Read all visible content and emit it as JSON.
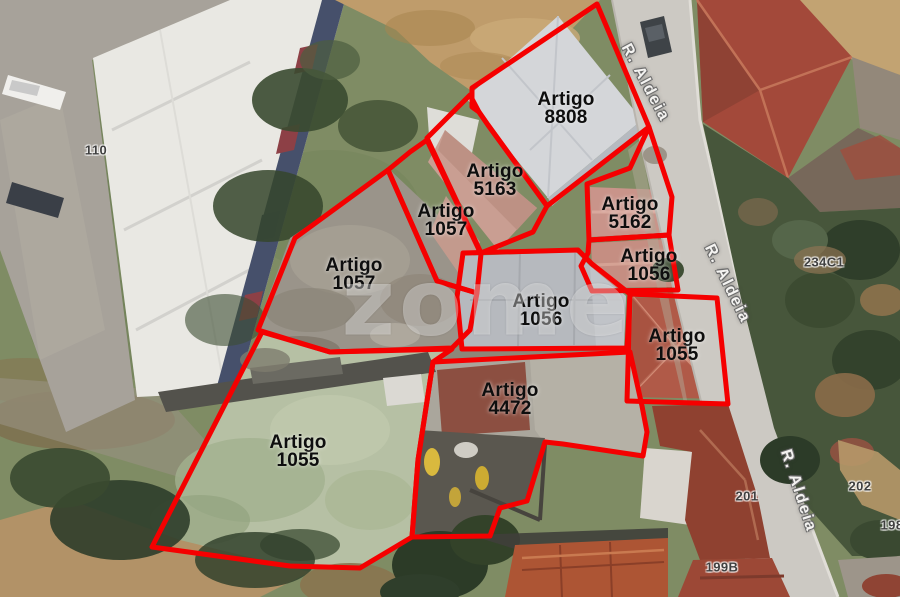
{
  "watermark": "zome",
  "map": {
    "boundary_color": "#f50000",
    "parcels": [
      {
        "name": "Artigo",
        "number": "8808",
        "label_x": 566,
        "label_y": 109,
        "points": "597,4 649,127 547,206 488,125 479,112 472,107 472,88"
      },
      {
        "name": "Artigo",
        "number": "5163",
        "label_x": 495,
        "label_y": 181,
        "points": "470,95 479,112 488,125 547,206 533,232 481,253 427,138"
      },
      {
        "name": "Artigo",
        "number": "1057",
        "label_x": 446,
        "label_y": 221,
        "points": "410,152 427,140 481,254 477,293 437,281 388,170"
      },
      {
        "name": "Artigo",
        "number": "1057",
        "label_x": 354,
        "label_y": 275,
        "points": "295,238 388,170 437,281 477,293 470,330 452,348 330,352 258,330"
      },
      {
        "name": "Artigo",
        "number": "5162",
        "label_x": 630,
        "label_y": 214,
        "points": "587,184 630,168 649,127 672,197 669,235 589,240"
      },
      {
        "name": "Artigo",
        "number": "1056",
        "label_x": 649,
        "label_y": 266,
        "points": "589,240 669,235 678,290 592,291 581,266 588,253"
      },
      {
        "name": "Artigo",
        "number": "1055",
        "label_x": 677,
        "label_y": 346,
        "points": "630,294 717,298 728,404 627,401"
      },
      {
        "name": "Artigo",
        "number": "1056",
        "label_x": 541,
        "label_y": 311,
        "points": "463,253 578,250 592,264 630,294 627,348 462,349 457,297"
      },
      {
        "name": "Artigo",
        "number": "4472",
        "label_x": 510,
        "label_y": 400,
        "points": "433,362 630,352 642,406 647,432 643,456 563,444 545,442 527,501 500,508 490,536 412,537 418,460"
      },
      {
        "name": "Artigo",
        "number": "1055",
        "label_x": 298,
        "label_y": 452,
        "points": "262,332 330,352 452,349 433,362 418,460 412,537 360,568 290,566 152,547"
      }
    ],
    "street_labels": [
      {
        "text": "R. Aldeia",
        "x": 645,
        "y": 83,
        "angle": 62
      },
      {
        "text": "R. Aldeia",
        "x": 727,
        "y": 284,
        "angle": 64
      },
      {
        "text": "R. Aldeia",
        "x": 798,
        "y": 491,
        "angle": 72
      }
    ],
    "house_numbers": [
      {
        "text": "110",
        "x": 96,
        "y": 150
      },
      {
        "text": "234C1",
        "x": 824,
        "y": 262
      },
      {
        "text": "201",
        "x": 747,
        "y": 496
      },
      {
        "text": "202",
        "x": 860,
        "y": 486
      },
      {
        "text": "199B",
        "x": 722,
        "y": 567
      },
      {
        "text": "198",
        "x": 892,
        "y": 525
      }
    ]
  }
}
